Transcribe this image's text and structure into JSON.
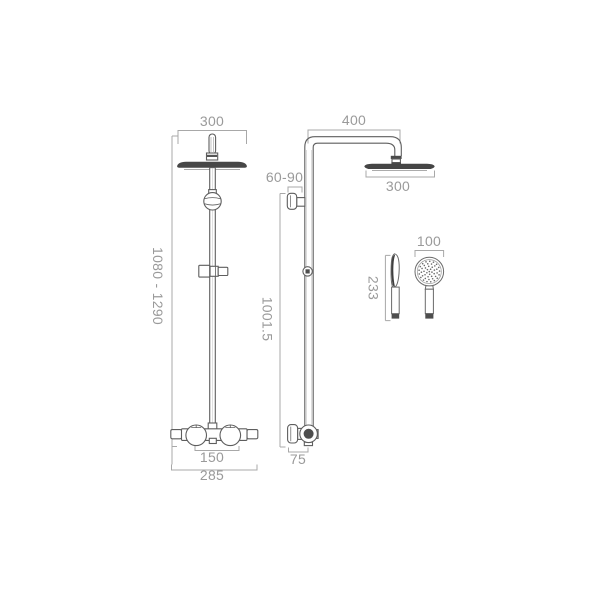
{
  "drawing": {
    "type": "technical-dimension-diagram",
    "subject": "thermostatic shower column with fixed head, riser rail and handheld shower",
    "colors": {
      "object_line": "#5e5e5e",
      "dark_fill": "#454545",
      "dimension_line": "#a8a8a8",
      "dimension_text": "#9a9a9a",
      "background": "#ffffff"
    },
    "views": {
      "front": {
        "name": "front elevation",
        "dimensions": {
          "head_width": "300",
          "height_range": "1080 - 1290",
          "handle_centres": "150",
          "valve_width": "285"
        }
      },
      "side": {
        "name": "side elevation",
        "dimensions": {
          "arm_projection": "400",
          "head_diameter": "300",
          "wall_offset": "60-90",
          "riser_height": "1001.5",
          "valve_projection": "75"
        }
      },
      "handset": {
        "name": "handset detail",
        "dimensions": {
          "head_diameter": "100",
          "length": "233"
        }
      }
    }
  }
}
